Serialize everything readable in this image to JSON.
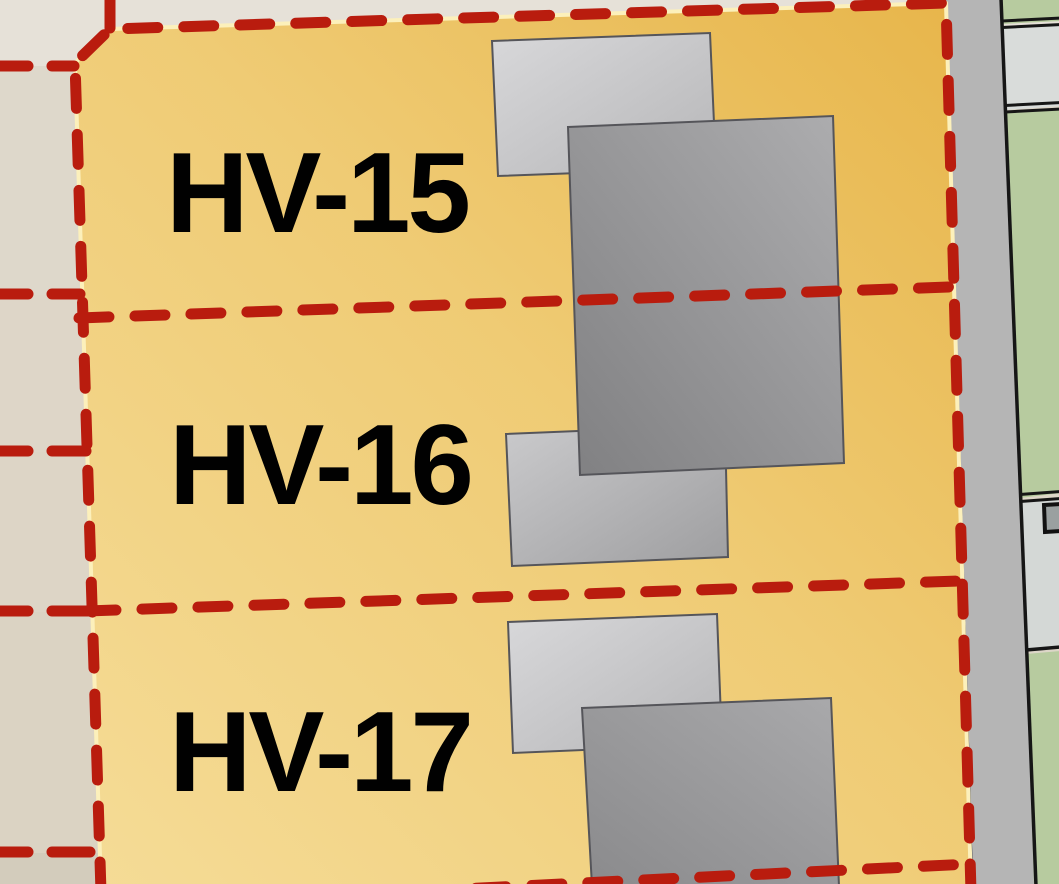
{
  "map": {
    "parcels": [
      {
        "label": "HV-15"
      },
      {
        "label": "HV-16"
      },
      {
        "label": "HV-17"
      }
    ],
    "colors": {
      "background_beige": "#ddd6c8",
      "background_top": "#e6e1d8",
      "parcel_fill_light": "#f4da93",
      "parcel_fill_dark": "#e8b84e",
      "parcel_halo_yellow": "#fcf0bb",
      "boundary_red": "#b91c0e",
      "road_gray": "#b5b5b5",
      "green_parcel": "#b7cb9f",
      "gray_parcel_upper": "#d9dcda",
      "gray_parcel_lower": "#d4d8d6",
      "utility_box_gray": "#9aa0a0",
      "building_light": "#cccccf",
      "building_dark": "#8f8f91",
      "line_black": "#161616",
      "label_text": "#010101"
    }
  }
}
